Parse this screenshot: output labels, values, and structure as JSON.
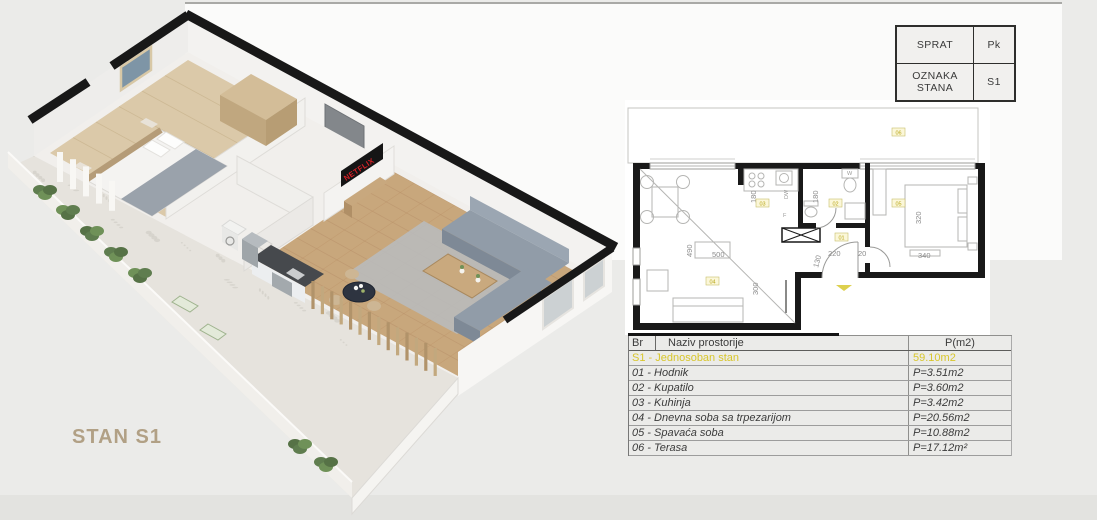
{
  "colors": {
    "accent_yellow": "#d8c62c",
    "wall_black": "#191919",
    "caption_tan": "#b1a085",
    "netflix_red": "#d81f26",
    "label_fill": "#fbf7d9"
  },
  "header_table": {
    "rows": [
      {
        "label": "SPRAT",
        "value": "Pk"
      },
      {
        "label": "OZNAKA STANA",
        "value": "S1"
      }
    ]
  },
  "room_table": {
    "columns": {
      "br": "Br",
      "name": "Naziv prostorije",
      "area": "P(m2)"
    },
    "highlight": {
      "name": "S1 - Jednosoban stan",
      "area": "59.10m2"
    },
    "rows": [
      {
        "name": "01 - Hodnik",
        "area": "P=3.51m2"
      },
      {
        "name": "02 - Kupatilo",
        "area": "P=3.60m2"
      },
      {
        "name": "03 - Kuhinja",
        "area": "P=3.42m2"
      },
      {
        "name": "04 - Dnevna soba sa trpezarijom",
        "area": "P=20.56m2"
      },
      {
        "name": "05 - Spavaća soba",
        "area": "P=10.88m2"
      },
      {
        "name": "06 - Terasa",
        "area": "P=17.12m²"
      }
    ]
  },
  "plan3d": {
    "caption": "STAN S1",
    "tv_brand": "NETFLIX"
  },
  "plan2d": {
    "dims": [
      "180",
      "180",
      "490",
      "500",
      "300",
      "130",
      "220",
      "20",
      "340",
      "320"
    ],
    "room_labels": [
      "01",
      "02",
      "03",
      "04",
      "05",
      "06"
    ],
    "fixture_labels": {
      "dw": "DW",
      "f": "F",
      "w": "W"
    }
  }
}
